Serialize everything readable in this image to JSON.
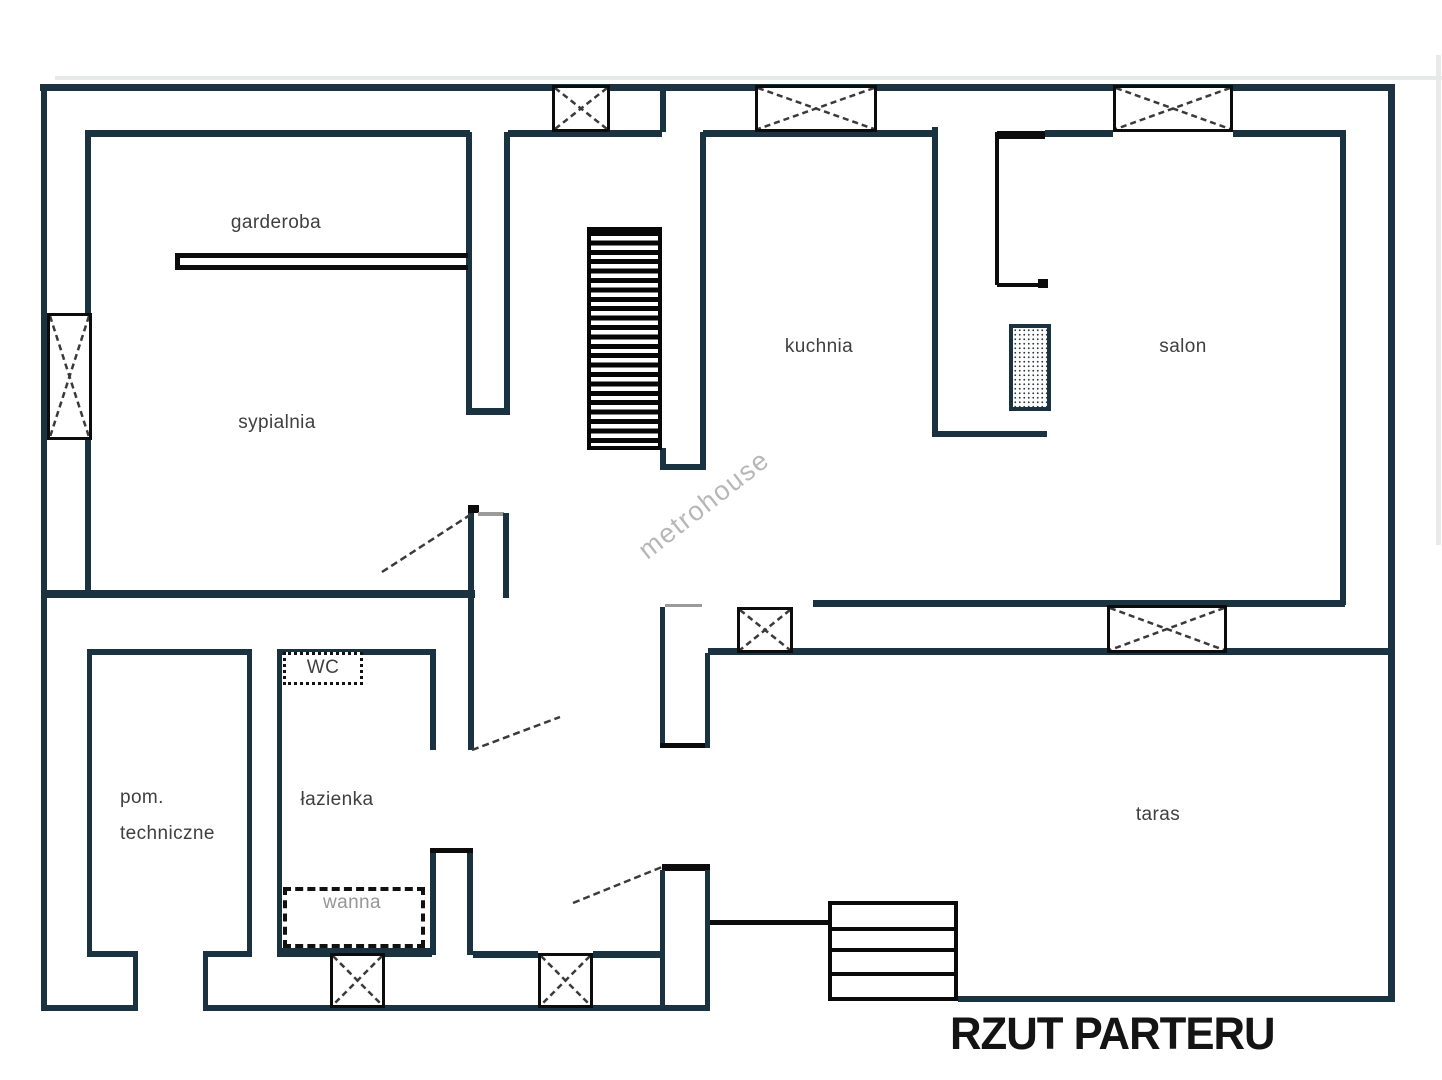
{
  "meta": {
    "title": "RZUT PARTERU",
    "watermark": "metrohouse"
  },
  "colors": {
    "wall": "#1b3340",
    "black": "#0c0c0c",
    "gray_line": "#9b9b9b",
    "band": "#e8e9e9",
    "label": "#3f3f3f",
    "muted": "#969696",
    "title": "#141414",
    "watermark": "#a6a6a6",
    "door": "#3a3a3a"
  },
  "rooms": [
    {
      "id": "garderoba",
      "label": "garderoba",
      "x": 276,
      "y": 223
    },
    {
      "id": "sypialnia",
      "label": "sypialnia",
      "x": 277,
      "y": 423
    },
    {
      "id": "kuchnia",
      "label": "kuchnia",
      "x": 819,
      "y": 347
    },
    {
      "id": "salon",
      "label": "salon",
      "x": 1183,
      "y": 347
    },
    {
      "id": "wc",
      "label": "WC",
      "x": 323,
      "y": 668
    },
    {
      "id": "lazienka",
      "label": "łazienka",
      "x": 337,
      "y": 800
    },
    {
      "id": "wanna",
      "label": "wanna",
      "x": 352,
      "y": 903,
      "muted": true
    },
    {
      "id": "pom-techniczne",
      "label": "pom.\ntechniczne",
      "x": 120,
      "y": 780,
      "align": "left"
    },
    {
      "id": "taras",
      "label": "taras",
      "x": 1158,
      "y": 815
    }
  ],
  "floorplan": {
    "walls": [
      [
        55,
        76,
        1387,
        4,
        "band"
      ],
      [
        1436,
        55,
        5,
        490,
        "band"
      ],
      [
        40,
        84,
        1355,
        7
      ],
      [
        41,
        84,
        6,
        927
      ],
      [
        1388,
        84,
        7,
        918
      ],
      [
        85,
        130,
        6,
        183
      ],
      [
        85,
        440,
        6,
        158
      ],
      [
        88,
        130,
        382,
        7
      ],
      [
        508,
        130,
        154,
        7
      ],
      [
        703,
        130,
        232,
        7
      ],
      [
        997,
        131,
        48,
        8,
        "b"
      ],
      [
        1045,
        130,
        68,
        7
      ],
      [
        1233,
        130,
        112,
        7
      ],
      [
        660,
        90,
        6,
        42
      ],
      [
        700,
        132,
        6,
        338
      ],
      [
        660,
        448,
        6,
        22
      ],
      [
        660,
        464,
        45,
        6
      ],
      [
        466,
        132,
        6,
        283
      ],
      [
        504,
        132,
        6,
        283
      ],
      [
        466,
        408,
        44,
        7
      ],
      [
        175,
        253,
        293,
        5,
        "b"
      ],
      [
        175,
        265,
        293,
        5,
        "b"
      ],
      [
        175,
        253,
        5,
        17,
        "b"
      ],
      [
        47,
        590,
        428,
        8
      ],
      [
        468,
        505,
        11,
        8,
        "b"
      ],
      [
        478,
        512,
        26,
        4,
        "g"
      ],
      [
        468,
        513,
        6,
        237
      ],
      [
        503,
        513,
        6,
        85
      ],
      [
        87,
        649,
        165,
        6
      ],
      [
        87,
        649,
        5,
        308
      ],
      [
        247,
        649,
        5,
        308
      ],
      [
        87,
        951,
        49,
        6
      ],
      [
        203,
        951,
        49,
        6
      ],
      [
        133,
        951,
        5,
        60
      ],
      [
        203,
        951,
        5,
        60
      ],
      [
        41,
        1005,
        97,
        6
      ],
      [
        203,
        1005,
        507,
        6
      ],
      [
        277,
        649,
        5,
        308
      ],
      [
        277,
        649,
        158,
        6
      ],
      [
        430,
        649,
        6,
        101
      ],
      [
        430,
        848,
        43,
        5,
        "b"
      ],
      [
        430,
        853,
        6,
        102
      ],
      [
        467,
        853,
        6,
        102
      ],
      [
        277,
        948,
        155,
        9
      ],
      [
        473,
        951,
        65,
        7
      ],
      [
        593,
        951,
        69,
        7
      ],
      [
        662,
        864,
        48,
        7,
        "b"
      ],
      [
        660,
        870,
        5,
        137
      ],
      [
        705,
        870,
        5,
        137
      ],
      [
        660,
        607,
        5,
        141
      ],
      [
        660,
        743,
        48,
        5,
        "b"
      ],
      [
        705,
        653,
        5,
        95
      ],
      [
        665,
        604,
        37,
        3,
        "g"
      ],
      [
        813,
        600,
        532,
        7
      ],
      [
        708,
        648,
        685,
        7
      ],
      [
        958,
        996,
        435,
        6
      ],
      [
        710,
        920,
        118,
        5,
        "b"
      ],
      [
        932,
        127,
        6,
        310
      ],
      [
        932,
        431,
        115,
        6
      ],
      [
        995,
        132,
        4,
        153,
        "b"
      ],
      [
        997,
        283,
        46,
        4,
        "b"
      ],
      [
        1038,
        279,
        10,
        9,
        "b"
      ],
      [
        1340,
        130,
        6,
        475
      ],
      [
        587,
        441,
        75,
        9,
        "b"
      ]
    ],
    "windows": [
      [
        47,
        313,
        45,
        127
      ],
      [
        552,
        85,
        58,
        47
      ],
      [
        755,
        85,
        122,
        47
      ],
      [
        1113,
        85,
        120,
        47
      ],
      [
        737,
        607,
        56,
        46
      ],
      [
        1107,
        605,
        120,
        48
      ],
      [
        538,
        953,
        55,
        55
      ],
      [
        330,
        953,
        55,
        55
      ]
    ],
    "doors": [
      [
        382,
        572,
        473,
        513
      ],
      [
        472,
        750,
        560,
        717
      ],
      [
        573,
        903,
        662,
        867
      ]
    ],
    "stairs": {
      "x": 587,
      "y": 227,
      "w": 75,
      "h": 223
    },
    "ext_steps": {
      "x": 828,
      "y": 901,
      "w": 130,
      "h": 100,
      "treads": [
        24,
        47,
        73
      ]
    },
    "wc_box": {
      "x": 283,
      "y": 652,
      "w": 80,
      "h": 33
    },
    "tub_box": {
      "x": 283,
      "y": 887,
      "w": 142,
      "h": 61
    },
    "dotted_box": {
      "x": 1009,
      "y": 324,
      "w": 42,
      "h": 87,
      "border": 4
    }
  }
}
